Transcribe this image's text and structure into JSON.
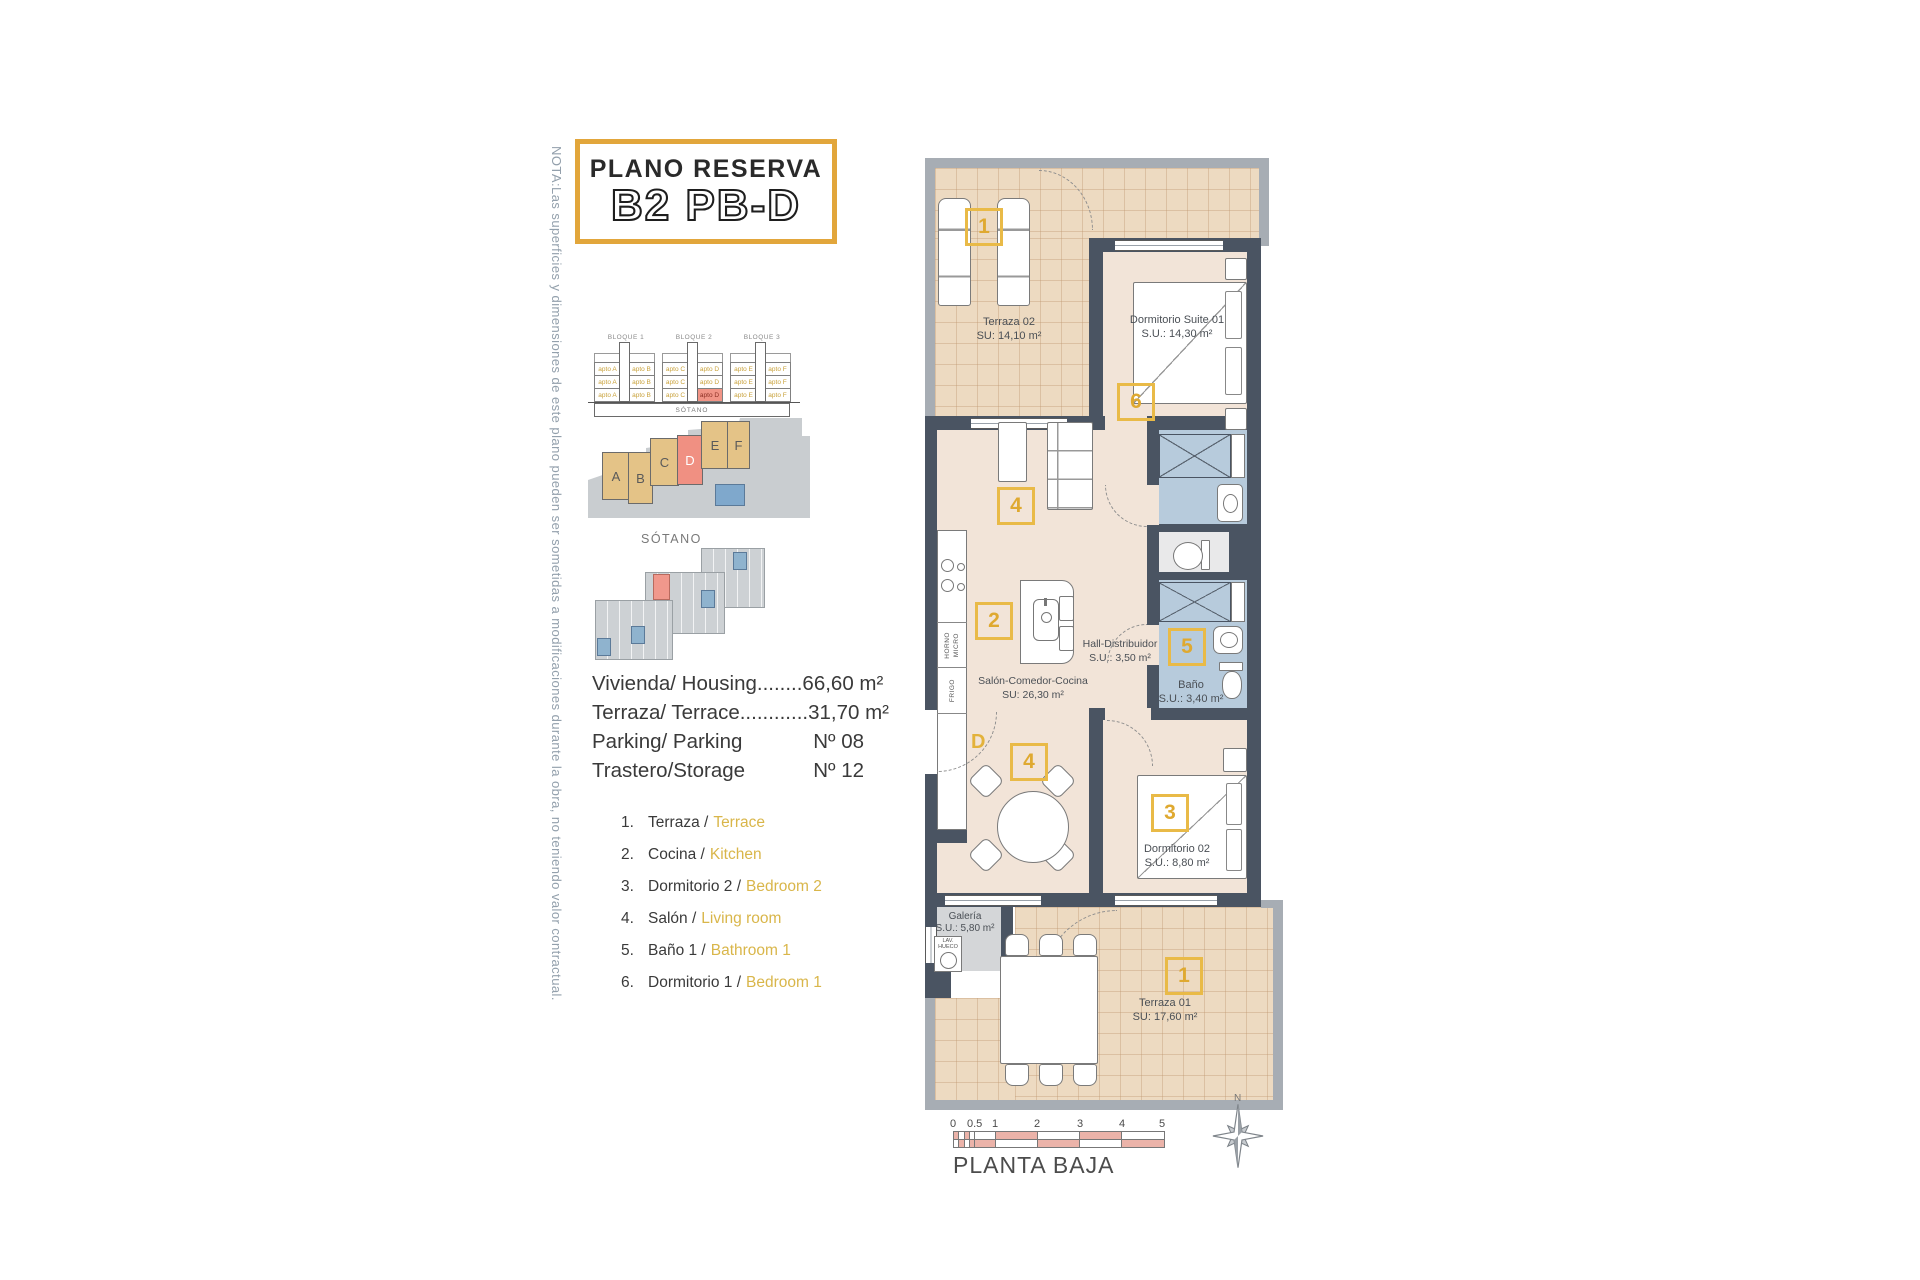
{
  "note": "NOTA:Las superficies y dimensiones de este plano pueden ser sometidas a modificaciones durante la obra, no teniendo valor contractual.",
  "title": {
    "line1": "PLANO RESERVA",
    "line2": "B2 PB-D"
  },
  "elevation": {
    "bloques": [
      "BLOQUE 1",
      "BLOQUE 2",
      "BLOQUE 3"
    ],
    "rows": [
      [
        "apto A",
        "apto B",
        "apto C",
        "apto D",
        "apto E",
        "apto F"
      ],
      [
        "apto A",
        "apto B",
        "apto C",
        "apto D",
        "apto E",
        "apto F"
      ],
      [
        "apto A",
        "apto B",
        "apto C",
        "apto D",
        "apto E",
        "apto F"
      ]
    ],
    "basement": "SÓTANO"
  },
  "siteplan": {
    "blocks": [
      "A",
      "B",
      "C",
      "D",
      "E",
      "F"
    ],
    "highlight": "D"
  },
  "sotano": {
    "label": "SÓTANO"
  },
  "info": {
    "row1": "Vivienda/ Housing........66,60 m²",
    "row2": "Terraza/ Terrace............31,70 m²",
    "row3_label": "Parking/ Parking",
    "row3_value": "Nº 08",
    "row4_label": "Trastero/Storage",
    "row4_value": "Nº 12"
  },
  "legend": [
    {
      "num": "1.",
      "es": "Terraza /",
      "en": "Terrace"
    },
    {
      "num": "2.",
      "es": "Cocina /",
      "en": "Kitchen"
    },
    {
      "num": "3.",
      "es": "Dormitorio 2 /",
      "en": "Bedroom 2"
    },
    {
      "num": "4.",
      "es": "Salón /",
      "en": "Living room"
    },
    {
      "num": "5.",
      "es": "Baño 1 /",
      "en": "Bathroom 1"
    },
    {
      "num": "6.",
      "es": "Dormitorio 1 /",
      "en": "Bedroom 1"
    }
  ],
  "plan": {
    "rooms": {
      "terraza02": {
        "name": "Terraza 02",
        "area": "SU: 14,10 m²",
        "marker": "1"
      },
      "suite": {
        "name": "Dormitorio Suite 01",
        "area": "S.U.: 14,30 m²",
        "marker": "6"
      },
      "salon": {
        "name": "Salón-Comedor-Cocina",
        "area": "SU: 26,30 m²",
        "marker_living": "4",
        "marker_kitchen": "2",
        "marker_dining": "4"
      },
      "hall": {
        "name": "Hall-Distribuidor",
        "area": "S.U.: 3,50 m²"
      },
      "bano": {
        "name": "Baño",
        "area": "S.U.: 3,40 m²",
        "marker": "5"
      },
      "dorm02": {
        "name": "Dormitorio 02",
        "area": "S.U.: 8,80 m²",
        "marker": "3"
      },
      "galeria": {
        "name": "Galería",
        "area": "S.U.: 5,80 m²",
        "appliance_line1": "LAV.",
        "appliance_line2": "HUECO"
      },
      "terraza01": {
        "name": "Terraza 01",
        "area": "SU: 17,60 m²",
        "marker": "1"
      }
    },
    "door_letter": "D",
    "kitchen_labels": {
      "oven": "HORNO",
      "micro": "MICRO",
      "fridge": "FRIGO"
    }
  },
  "scalebar": {
    "ticks": [
      "0",
      "0.5",
      "1",
      "2",
      "3",
      "4",
      "5"
    ],
    "label": "PLANTA BAJA"
  },
  "compass": {
    "north": "N"
  },
  "colors": {
    "accent_gold": "#E2A63B",
    "marker_yellow": "#E9BA47",
    "wall_dark": "#4A5462",
    "terrace_wall": "#A7ADB4",
    "floor_tile": "#EDDAC1",
    "floor_room": "#F2E4D8",
    "wet_blue": "#B7CBDC",
    "highlight_red": "#F09082",
    "scale_red": "#EBB3A9",
    "note_gray": "#93A0AC",
    "legend_en_yellow": "#D9B64A"
  }
}
